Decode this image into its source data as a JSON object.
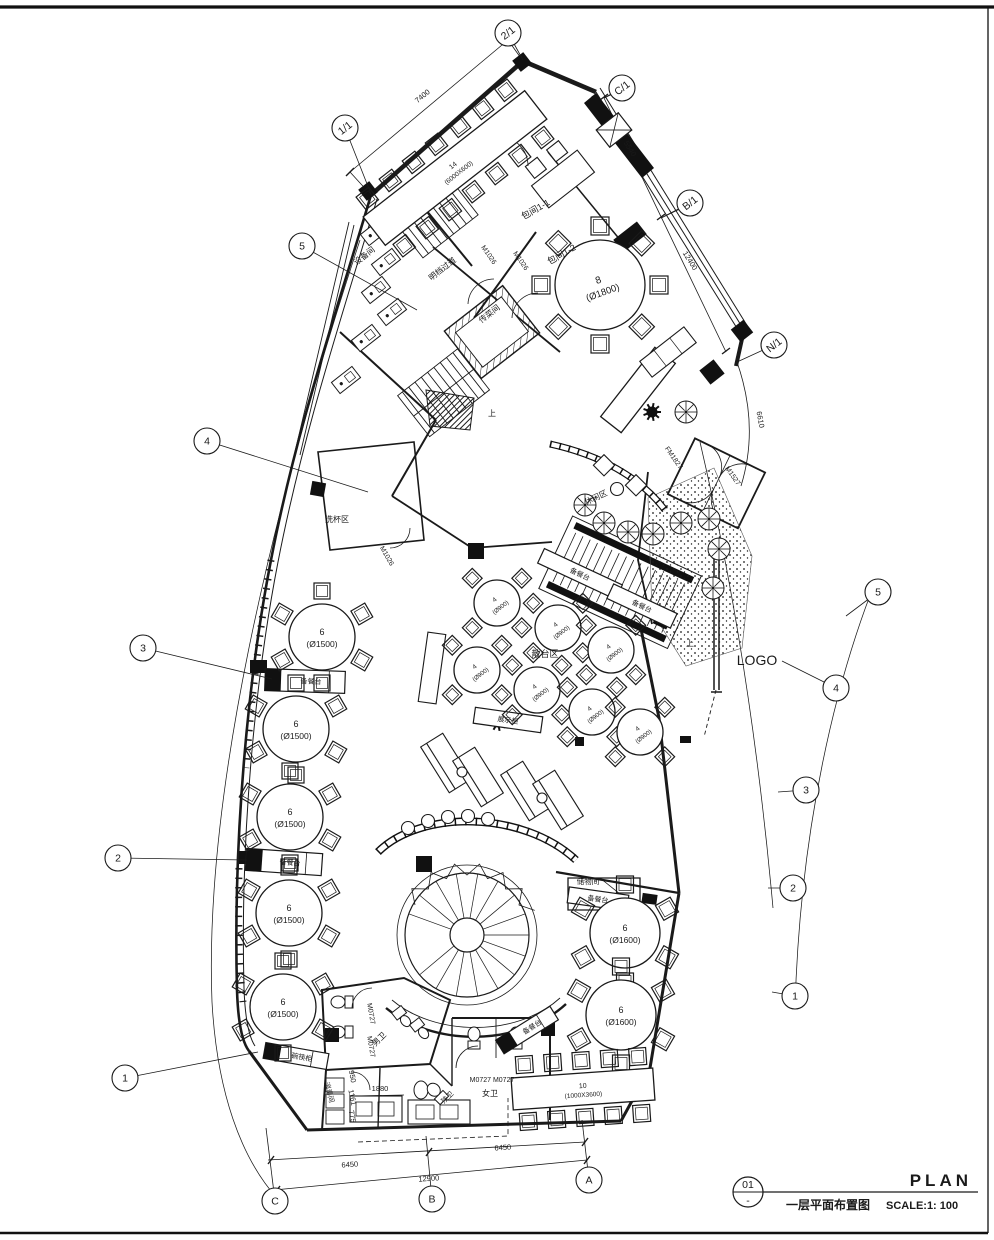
{
  "title_block": {
    "number": "01",
    "number_sub": "-",
    "title_en": "PLAN",
    "title_cn": "一层平面布置图",
    "scale": "SCALE:1: 100"
  },
  "grid_bubbles": [
    {
      "label": "5",
      "x": 302,
      "y": 246,
      "lx": 417,
      "ly": 310
    },
    {
      "label": "4",
      "x": 207,
      "y": 441,
      "lx": 368,
      "ly": 492
    },
    {
      "label": "3",
      "x": 143,
      "y": 648,
      "lx": 272,
      "ly": 679
    },
    {
      "label": "2",
      "x": 118,
      "y": 858,
      "lx": 247,
      "ly": 860
    },
    {
      "label": "1",
      "x": 125,
      "y": 1078,
      "lx": 258,
      "ly": 1052
    },
    {
      "label": "5",
      "x": 878,
      "y": 592,
      "lx": 846,
      "ly": 616
    },
    {
      "label": "4",
      "x": 836,
      "y": 688,
      "lx": 782,
      "ly": 661
    },
    {
      "label": "3",
      "x": 806,
      "y": 790,
      "lx": 778,
      "ly": 792
    },
    {
      "label": "2",
      "x": 793,
      "y": 888,
      "lx": 768,
      "ly": 888
    },
    {
      "label": "1",
      "x": 795,
      "y": 996,
      "lx": 772,
      "ly": 992
    },
    {
      "label": "1/1",
      "x": 345,
      "y": 128,
      "lx": 371,
      "ly": 194,
      "a": -38
    },
    {
      "label": "2/1",
      "x": 508,
      "y": 33,
      "lx": 523,
      "ly": 60,
      "a": -38
    },
    {
      "label": "C/1",
      "x": 622,
      "y": 88,
      "lx": 604,
      "ly": 98,
      "a": -38
    },
    {
      "label": "B/1",
      "x": 690,
      "y": 203,
      "lx": 661,
      "ly": 218,
      "a": -38
    },
    {
      "label": "N/1",
      "x": 774,
      "y": 345,
      "lx": 737,
      "ly": 362,
      "a": -38
    },
    {
      "label": "C",
      "x": 275,
      "y": 1201,
      "lx": 266,
      "ly": 1128
    },
    {
      "label": "B",
      "x": 432,
      "y": 1199,
      "lx": 426,
      "ly": 1136
    },
    {
      "label": "A",
      "x": 589,
      "y": 1180,
      "lx": 582,
      "ly": 1120
    }
  ],
  "dimensions": [
    {
      "text": "7400",
      "x": 424,
      "y": 98,
      "angle": -40
    },
    {
      "text": "5540",
      "x": 628,
      "y": 150,
      "angle": 58
    },
    {
      "text": "12400",
      "x": 688,
      "y": 262,
      "angle": 58
    },
    {
      "text": "6610",
      "x": 758,
      "y": 420,
      "angle": 80
    },
    {
      "text": "6450",
      "x": 350,
      "y": 1167,
      "angle": -4
    },
    {
      "text": "6450",
      "x": 503,
      "y": 1150,
      "angle": -4
    },
    {
      "text": "12900",
      "x": 429,
      "y": 1181,
      "angle": -4
    },
    {
      "text": "1880",
      "x": 380,
      "y": 1091,
      "angle": 0
    },
    {
      "text": "950",
      "x": 350,
      "y": 1077,
      "angle": 78
    },
    {
      "text": "1161",
      "x": 350,
      "y": 1098,
      "angle": 78
    },
    {
      "text": "775",
      "x": 350,
      "y": 1117,
      "angle": 78
    }
  ],
  "room_labels": [
    {
      "t": "包间1-1",
      "x": 537,
      "y": 212,
      "a": -30,
      "s": 9
    },
    {
      "t": "包间1-2",
      "x": 563,
      "y": 257,
      "a": -30,
      "s": 9
    },
    {
      "t": "设备间",
      "x": 366,
      "y": 258,
      "a": -38,
      "s": 8
    },
    {
      "t": "明档过道",
      "x": 444,
      "y": 271,
      "a": -38,
      "s": 8
    },
    {
      "t": "传菜间",
      "x": 491,
      "y": 316,
      "a": -38,
      "s": 8
    },
    {
      "t": "洗杯区",
      "x": 337,
      "y": 522,
      "a": 0,
      "s": 8
    },
    {
      "t": "散台区",
      "x": 545,
      "y": 657,
      "a": 0,
      "s": 9
    },
    {
      "t": "休闲区",
      "x": 597,
      "y": 500,
      "a": -25,
      "s": 8
    },
    {
      "t": "储物间",
      "x": 588,
      "y": 884,
      "a": 0,
      "s": 7.5
    },
    {
      "t": "男卫",
      "x": 381,
      "y": 1041,
      "a": -45,
      "s": 8
    },
    {
      "t": "女卫",
      "x": 490,
      "y": 1096,
      "a": 0,
      "s": 8
    },
    {
      "t": "残卫",
      "x": 449,
      "y": 1099,
      "a": -45,
      "s": 7
    },
    {
      "t": "消毒间",
      "x": 327,
      "y": 1093,
      "a": 75,
      "s": 7
    },
    {
      "t": "上",
      "x": 492,
      "y": 416,
      "a": 0,
      "s": 8
    },
    {
      "t": "上",
      "x": 690,
      "y": 646,
      "a": 0,
      "s": 8
    },
    {
      "t": "M1026",
      "x": 487,
      "y": 256,
      "a": 55,
      "s": 7
    },
    {
      "t": "M1026",
      "x": 519,
      "y": 262,
      "a": 55,
      "s": 7
    },
    {
      "t": "M1026",
      "x": 385,
      "y": 557,
      "a": 60,
      "s": 7
    },
    {
      "t": "FM1827",
      "x": 672,
      "y": 459,
      "a": 55,
      "s": 7
    },
    {
      "t": "M1527",
      "x": 731,
      "y": 477,
      "a": 55,
      "s": 7
    },
    {
      "t": "M0727",
      "x": 369,
      "y": 1014,
      "a": 80,
      "s": 7
    },
    {
      "t": "M0727",
      "x": 369,
      "y": 1047,
      "a": 80,
      "s": 7
    },
    {
      "t": "M0727 M0727",
      "x": 492,
      "y": 1082,
      "a": 0,
      "s": 7
    },
    {
      "t": "LOGO",
      "x": 757,
      "y": 665,
      "a": 0,
      "s": 14
    }
  ],
  "round_tables": [
    {
      "x": 600,
      "y": 285,
      "r": 45,
      "seats": 8,
      "chair": 18,
      "l1": "8",
      "l2": "(Ø1800)",
      "la": -20,
      "f": 10
    },
    {
      "x": 322,
      "y": 637,
      "r": 33,
      "seats": 6,
      "chair": 16,
      "l1": "6",
      "l2": "(Ø1500)",
      "la": 0,
      "f": 9
    },
    {
      "x": 296,
      "y": 729,
      "r": 33,
      "seats": 6,
      "chair": 16,
      "l1": "6",
      "l2": "(Ø1500)",
      "la": 0,
      "f": 9
    },
    {
      "x": 290,
      "y": 817,
      "r": 33,
      "seats": 6,
      "chair": 16,
      "l1": "6",
      "l2": "(Ø1500)",
      "la": 0,
      "f": 9
    },
    {
      "x": 289,
      "y": 913,
      "r": 33,
      "seats": 6,
      "chair": 16,
      "l1": "6",
      "l2": "(Ø1500)",
      "la": 0,
      "f": 9
    },
    {
      "x": 283,
      "y": 1007,
      "r": 33,
      "seats": 6,
      "chair": 16,
      "l1": "6",
      "l2": "(Ø1500)",
      "la": 0,
      "f": 9
    },
    {
      "x": 625,
      "y": 933,
      "r": 35,
      "seats": 6,
      "chair": 17,
      "l1": "6",
      "l2": "(Ø1600)",
      "la": 0,
      "f": 9
    },
    {
      "x": 621,
      "y": 1015,
      "r": 35,
      "seats": 6,
      "chair": 17,
      "l1": "6",
      "l2": "(Ø1600)",
      "la": 0,
      "f": 9
    },
    {
      "x": 497,
      "y": 603,
      "r": 23,
      "seats": 4,
      "chair": 14,
      "l1": "4",
      "l2": "(Ø900)",
      "la": -38,
      "f": 6.5,
      "start": -135
    },
    {
      "x": 558,
      "y": 628,
      "r": 23,
      "seats": 4,
      "chair": 14,
      "l1": "4",
      "l2": "(Ø900)",
      "la": -38,
      "f": 6.5,
      "start": -135
    },
    {
      "x": 611,
      "y": 650,
      "r": 23,
      "seats": 4,
      "chair": 14,
      "l1": "4",
      "l2": "(Ø900)",
      "la": -38,
      "f": 6.5,
      "start": -135
    },
    {
      "x": 477,
      "y": 670,
      "r": 23,
      "seats": 4,
      "chair": 14,
      "l1": "4",
      "l2": "(Ø900)",
      "la": -38,
      "f": 6.5,
      "start": -135
    },
    {
      "x": 537,
      "y": 690,
      "r": 23,
      "seats": 4,
      "chair": 14,
      "l1": "4",
      "l2": "(Ø900)",
      "la": -38,
      "f": 6.5,
      "start": -135
    },
    {
      "x": 592,
      "y": 712,
      "r": 23,
      "seats": 4,
      "chair": 14,
      "l1": "4",
      "l2": "(Ø900)",
      "la": -38,
      "f": 6.5,
      "start": -135
    },
    {
      "x": 640,
      "y": 732,
      "r": 23,
      "seats": 4,
      "chair": 14,
      "l1": "4",
      "l2": "(Ø900)",
      "la": -38,
      "f": 6.5,
      "start": -135
    }
  ],
  "rect_tables": [
    {
      "x": 455,
      "y": 168,
      "w": 205,
      "h": 36,
      "angle": -38,
      "l1": "14",
      "l2": "(6000X600)",
      "per_side": 7,
      "chair": 16,
      "f": 7
    },
    {
      "x": 583,
      "y": 1089,
      "w": 142,
      "h": 32,
      "angle": -4,
      "l1": "10",
      "l2": "(1000X3600)",
      "per_side": 5,
      "chair": 17,
      "f": 7
    }
  ],
  "counters": [
    {
      "x": 305,
      "y": 681,
      "w": 80,
      "h": 22,
      "a": 2,
      "label": "备餐台",
      "black": "left"
    },
    {
      "x": 284,
      "y": 862,
      "w": 76,
      "h": 22,
      "a": 4,
      "label": "备餐台",
      "black": "left"
    },
    {
      "x": 580,
      "y": 574,
      "w": 86,
      "h": 16,
      "a": 25,
      "label": "备餐台",
      "black": "none"
    },
    {
      "x": 642,
      "y": 606,
      "w": 70,
      "h": 16,
      "a": 25,
      "label": "备餐台",
      "black": "none"
    },
    {
      "x": 527,
      "y": 1030,
      "w": 64,
      "h": 16,
      "a": -32,
      "label": "备餐台",
      "black": "left"
    },
    {
      "x": 598,
      "y": 899,
      "w": 60,
      "h": 16,
      "a": 8,
      "label": "备餐台",
      "black": "none"
    },
    {
      "x": 296,
      "y": 1056,
      "w": 64,
      "h": 16,
      "a": 10,
      "label": "碗筷柜",
      "black": "left"
    },
    {
      "x": 508,
      "y": 720,
      "w": 68,
      "h": 16,
      "a": 8,
      "label": "展示柜",
      "black": "none"
    }
  ]
}
